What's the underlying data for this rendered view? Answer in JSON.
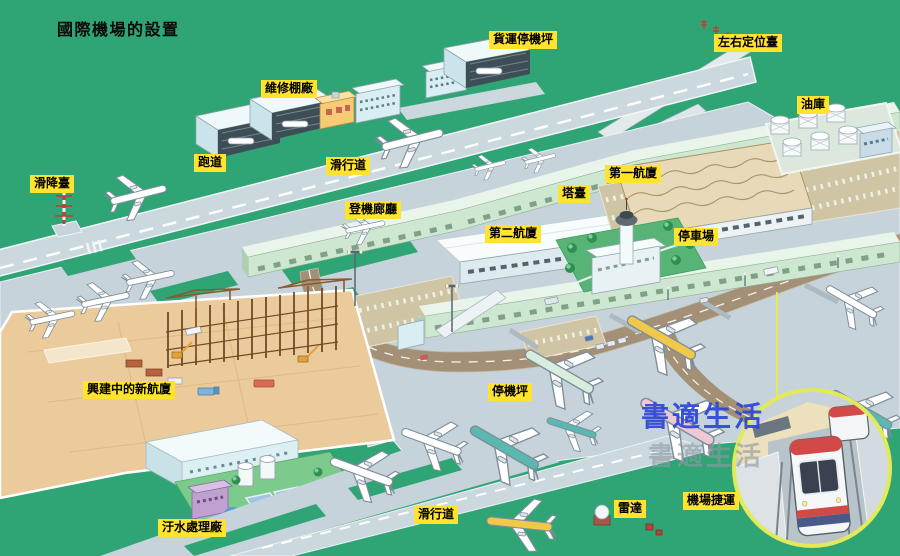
{
  "title": "國際機場的設置",
  "watermark": {
    "text": "書適生活"
  },
  "labels": {
    "cargo_apron": "貨運停機坪",
    "localizer": "左右定位臺",
    "maintenance_hangar": "維修棚廠",
    "fuel_depot": "油庫",
    "runway": "跑道",
    "taxiway_top": "滑行道",
    "glide_slope": "滑降臺",
    "terminal_1": "第一航廈",
    "control_tower": "塔臺",
    "boarding_corridor": "登機廊廳",
    "terminal_2": "第二航廈",
    "parking_lot": "停車場",
    "new_terminal_under_construction": "興建中的新航廈",
    "apron": "停機坪",
    "sewage_treatment_plant": "汙水處理廠",
    "taxiway_bottom": "滑行道",
    "radar": "雷達",
    "airport_mrt": "機場捷運"
  },
  "colors": {
    "bg-green": "#2FA475",
    "tarmac": "#C6D3DA",
    "runway-gray": "#CBD8DE",
    "label-bg": "#FFE32E",
    "sand": "#EBCA9B",
    "concourse-green": "#CDE7D0",
    "road-brown": "#A39076",
    "park-green": "#57B476",
    "lawn-green": "#7CCB8D",
    "roof-tan": "#E8DAB8",
    "pool-blue": "#9FC6E4",
    "watermark-blue": "#2B46D9",
    "watermark-gray": "#8E99A3",
    "inset-border": "#E3EA5A"
  }
}
